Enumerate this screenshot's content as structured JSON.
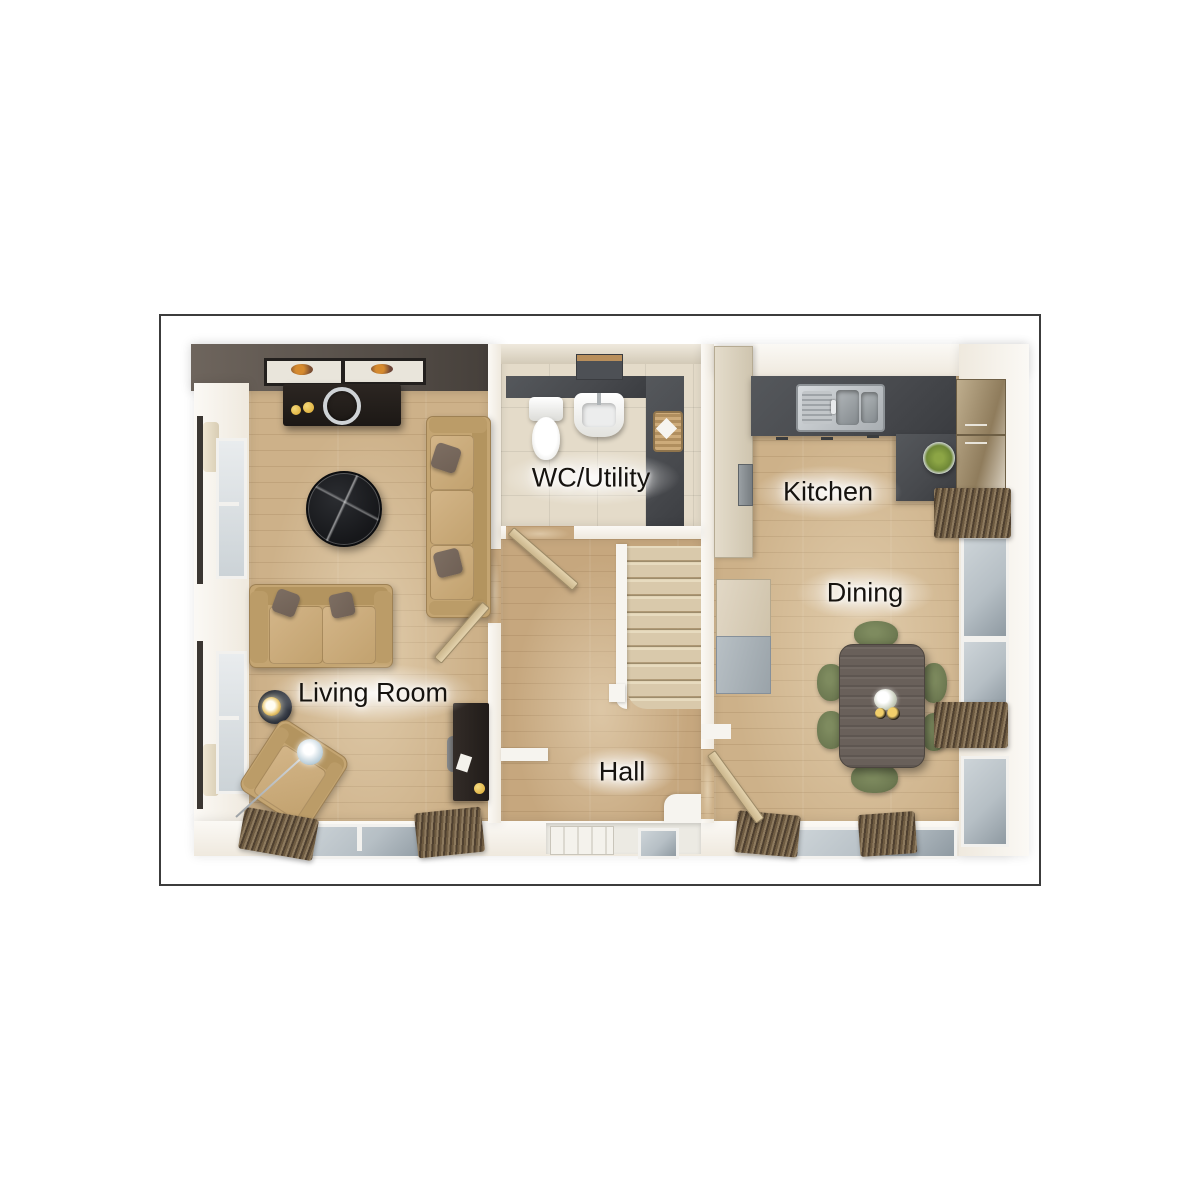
{
  "title": "Ground floor plan",
  "palette": {
    "c-frame": "#3c3c3c",
    "c-wall": "#efe9de",
    "c-wall-dark-1": "#6e655d",
    "c-wall-dark-2": "#46403b",
    "c-wood": "#cdb189",
    "c-wood-hall": "#c6a77e",
    "c-tile": "#e4dbc9",
    "c-slate": "#47494d",
    "c-carpet": "#d9c9ab",
    "c-sofa": "#c4a572",
    "c-pillow": "#6f6055",
    "c-olive": "#6e7a52",
    "c-table": "#69605a",
    "c-marble": "#16171a",
    "c-radiator-a": "#8d7a5e",
    "c-radiator-b": "#4f4030",
    "c-glass": "#b6bfc5",
    "c-gold": "#d9a62e",
    "c-label": "#16130f"
  },
  "plan": {
    "rooms": [
      {
        "id": "living-room",
        "label": "Living Room"
      },
      {
        "id": "wc-utility",
        "label": "WC/Utility"
      },
      {
        "id": "kitchen",
        "label": "Kitchen"
      },
      {
        "id": "dining",
        "label": "Dining"
      },
      {
        "id": "hall",
        "label": "Hall"
      }
    ],
    "furniture_icons": {
      "living_room": [
        "picture-frame-icon",
        "media-console-icon",
        "round-coffee-table-icon",
        "three-seat-sofa-icon",
        "two-seat-sofa-icon",
        "side-table-lamp-icon",
        "armchair-icon",
        "arc-floor-lamp-icon",
        "desk-icon",
        "radiator-icon",
        "window-icon",
        "curtain-icon"
      ],
      "wc_utility": [
        "toilet-icon",
        "basin-icon",
        "mirror-shelf-icon",
        "laundry-basket-icon"
      ],
      "kitchen": [
        "sink-drainer-icon",
        "worktop-icon",
        "tall-unit-icon",
        "wall-cabinet-icon",
        "fruit-bowl-icon",
        "oven-icon",
        "radiator-icon"
      ],
      "dining": [
        "dining-table-icon",
        "dining-chair-icon",
        "centerpiece-icon",
        "radiator-icon",
        "storage-unit-icon"
      ],
      "hall": [
        "staircase-icon",
        "front-door-icon",
        "internal-door-icon"
      ]
    }
  }
}
